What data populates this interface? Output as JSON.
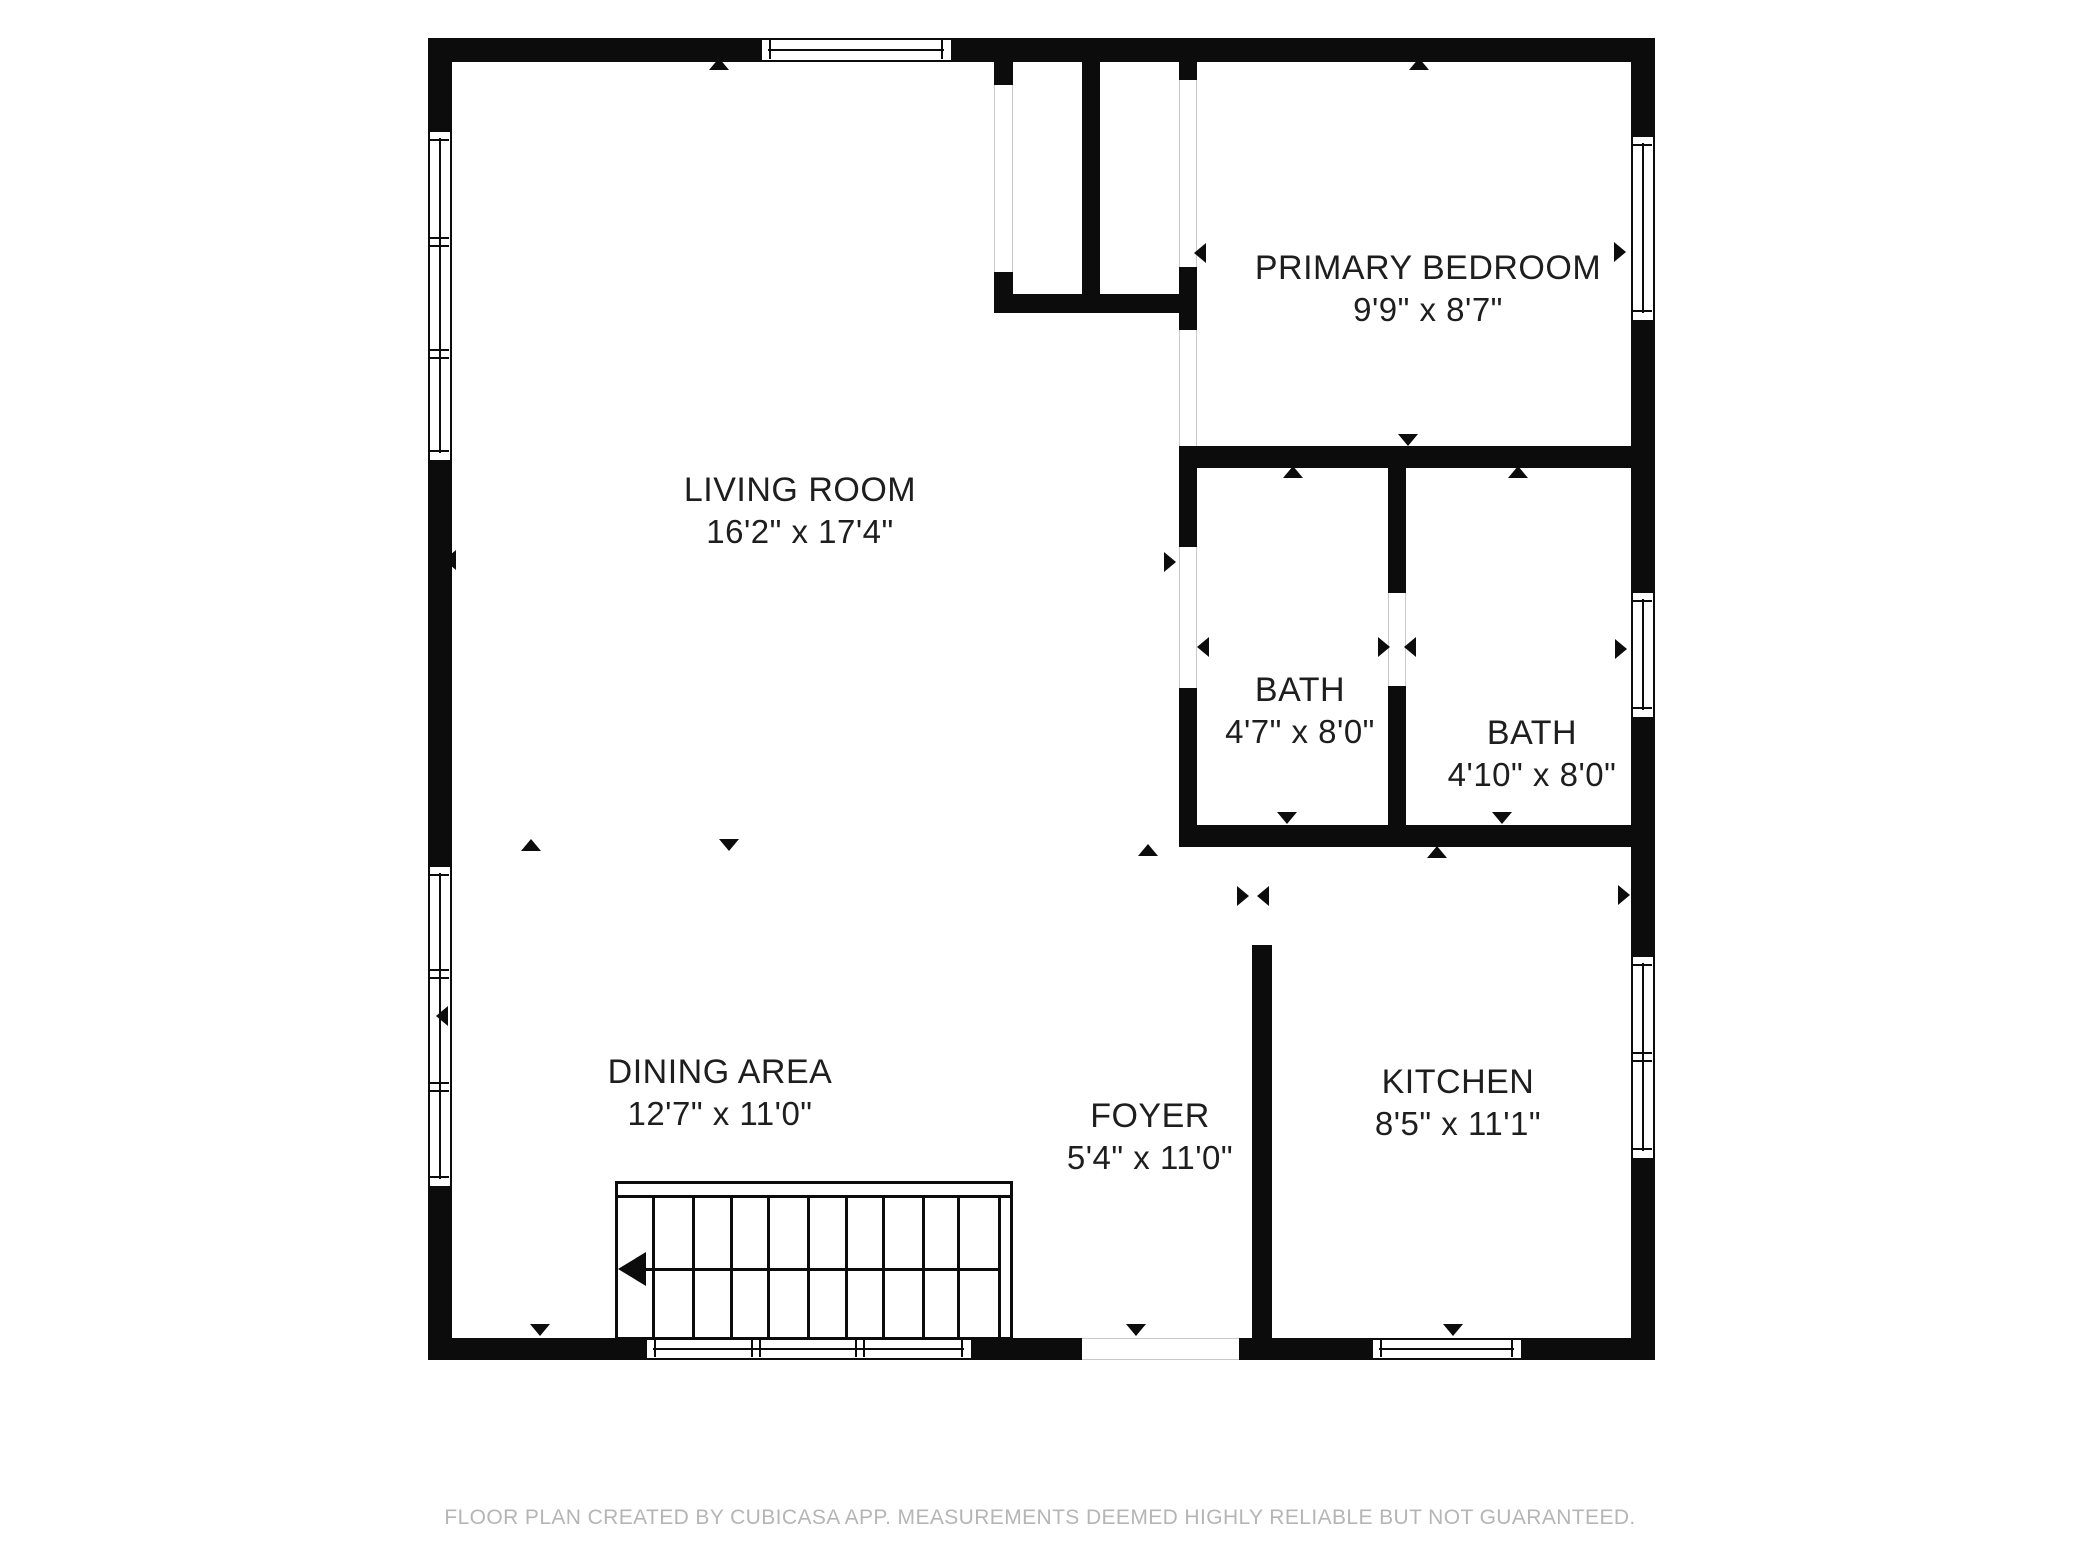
{
  "footer": {
    "text": "FLOOR PLAN CREATED BY CUBICASA APP. MEASUREMENTS DEEMED HIGHLY RELIABLE BUT NOT GUARANTEED."
  },
  "colors": {
    "wall": "#0c0c0c",
    "background": "#ffffff",
    "label_text": "#1e1e1e",
    "footer_text": "#b5b5b5",
    "gap_edge": "#c9c9c9"
  },
  "canvas": {
    "width": 2080,
    "height": 1560
  },
  "rooms": [
    {
      "id": "living-room",
      "name": "LIVING ROOM",
      "dims": "16'2\" x 17'4\"",
      "cx": 800,
      "cy": 490
    },
    {
      "id": "primary-bedroom",
      "name": "PRIMARY BEDROOM",
      "dims": "9'9\" x 8'7\"",
      "cx": 1428,
      "cy": 268
    },
    {
      "id": "bath-1",
      "name": "BATH",
      "dims": "4'7\" x 8'0\"",
      "cx": 1300,
      "cy": 690
    },
    {
      "id": "bath-2",
      "name": "BATH",
      "dims": "4'10\" x 8'0\"",
      "cx": 1532,
      "cy": 733
    },
    {
      "id": "dining-area",
      "name": "DINING AREA",
      "dims": "12'7\" x 11'0\"",
      "cx": 720,
      "cy": 1072
    },
    {
      "id": "foyer",
      "name": "FOYER",
      "dims": "5'4\" x 11'0\"",
      "cx": 1150,
      "cy": 1116
    },
    {
      "id": "kitchen",
      "name": "KITCHEN",
      "dims": "8'5\" x 11'1\"",
      "cx": 1458,
      "cy": 1082
    }
  ],
  "walls": [
    {
      "x": 428,
      "y": 38,
      "w": 332,
      "h": 24
    },
    {
      "x": 953,
      "y": 38,
      "w": 702,
      "h": 24
    },
    {
      "x": 428,
      "y": 38,
      "w": 24,
      "h": 92
    },
    {
      "x": 428,
      "y": 462,
      "w": 24,
      "h": 403
    },
    {
      "x": 428,
      "y": 1188,
      "w": 24,
      "h": 172
    },
    {
      "x": 1631,
      "y": 38,
      "w": 24,
      "h": 97
    },
    {
      "x": 1631,
      "y": 322,
      "w": 24,
      "h": 269
    },
    {
      "x": 1631,
      "y": 719,
      "w": 24,
      "h": 236
    },
    {
      "x": 1631,
      "y": 1160,
      "w": 24,
      "h": 200
    },
    {
      "x": 428,
      "y": 1338,
      "w": 217,
      "h": 22
    },
    {
      "x": 973,
      "y": 1338,
      "w": 109,
      "h": 22
    },
    {
      "x": 1239,
      "y": 1338,
      "w": 132,
      "h": 22
    },
    {
      "x": 1523,
      "y": 1338,
      "w": 132,
      "h": 22
    },
    {
      "x": 1082,
      "y": 62,
      "w": 18,
      "h": 251
    },
    {
      "x": 994,
      "y": 62,
      "w": 19,
      "h": 23
    },
    {
      "x": 994,
      "y": 272,
      "w": 19,
      "h": 22
    },
    {
      "x": 994,
      "y": 294,
      "w": 189,
      "h": 19
    },
    {
      "x": 1179,
      "y": 62,
      "w": 18,
      "h": 18
    },
    {
      "x": 1179,
      "y": 267,
      "w": 18,
      "h": 63
    },
    {
      "x": 1179,
      "y": 446,
      "w": 476,
      "h": 22
    },
    {
      "x": 1179,
      "y": 468,
      "w": 18,
      "h": 79
    },
    {
      "x": 1179,
      "y": 688,
      "w": 18,
      "h": 159
    },
    {
      "x": 1388,
      "y": 468,
      "w": 18,
      "h": 125
    },
    {
      "x": 1388,
      "y": 686,
      "w": 18,
      "h": 161
    },
    {
      "x": 1179,
      "y": 825,
      "w": 476,
      "h": 22
    },
    {
      "x": 1252,
      "y": 945,
      "w": 20,
      "h": 415
    }
  ],
  "windows": [
    {
      "orient": "h",
      "x": 760,
      "y": 38,
      "len": 193,
      "th": 24,
      "divs": []
    },
    {
      "orient": "v",
      "x": 428,
      "y": 130,
      "len": 332,
      "th": 24,
      "divs": [
        110,
        222
      ]
    },
    {
      "orient": "v",
      "x": 428,
      "y": 865,
      "len": 323,
      "th": 24,
      "divs": [
        107,
        220
      ]
    },
    {
      "orient": "v",
      "x": 1631,
      "y": 135,
      "len": 187,
      "th": 24,
      "divs": []
    },
    {
      "orient": "v",
      "x": 1631,
      "y": 591,
      "len": 128,
      "th": 24,
      "divs": []
    },
    {
      "orient": "v",
      "x": 1631,
      "y": 955,
      "len": 205,
      "th": 24,
      "divs": [
        100
      ]
    },
    {
      "orient": "h",
      "x": 645,
      "y": 1338,
      "len": 328,
      "th": 22,
      "divs": [
        109,
        213
      ]
    },
    {
      "orient": "h",
      "x": 1371,
      "y": 1338,
      "len": 152,
      "th": 22,
      "divs": []
    }
  ],
  "door_gaps": [
    {
      "orient": "v",
      "x": 994,
      "y": 85,
      "w": 19,
      "h": 187
    },
    {
      "orient": "v",
      "x": 1179,
      "y": 80,
      "w": 18,
      "h": 187
    },
    {
      "orient": "v",
      "x": 1179,
      "y": 330,
      "w": 18,
      "h": 116
    },
    {
      "orient": "v",
      "x": 1179,
      "y": 547,
      "w": 18,
      "h": 141
    },
    {
      "orient": "v",
      "x": 1388,
      "y": 593,
      "w": 18,
      "h": 93
    },
    {
      "orient": "h",
      "x": 1082,
      "y": 1338,
      "w": 157,
      "h": 22
    }
  ],
  "stairs": {
    "x": 615,
    "y": 1181,
    "w": 398,
    "h": 159,
    "inner_top": 11,
    "inner_right": 380,
    "treads": [
      34,
      74,
      112,
      149,
      189,
      227,
      264,
      304,
      339
    ],
    "dir_line_y": 84,
    "dir_line_x1": 14,
    "dir_line_x2": 380
  },
  "markers": [
    {
      "dir": "up",
      "x": 719,
      "y": 64
    },
    {
      "dir": "up",
      "x": 1419,
      "y": 64
    },
    {
      "dir": "left",
      "x": 1200,
      "y": 253
    },
    {
      "dir": "right",
      "x": 1620,
      "y": 252
    },
    {
      "dir": "left",
      "x": 450,
      "y": 560
    },
    {
      "dir": "left",
      "x": 442,
      "y": 1016
    },
    {
      "dir": "up",
      "x": 531,
      "y": 845
    },
    {
      "dir": "down",
      "x": 729,
      "y": 845
    },
    {
      "dir": "up",
      "x": 1148,
      "y": 850
    },
    {
      "dir": "down",
      "x": 1408,
      "y": 440
    },
    {
      "dir": "right",
      "x": 1170,
      "y": 562
    },
    {
      "dir": "left",
      "x": 1203,
      "y": 647
    },
    {
      "dir": "up",
      "x": 1293,
      "y": 472
    },
    {
      "dir": "up",
      "x": 1518,
      "y": 472
    },
    {
      "dir": "right",
      "x": 1384,
      "y": 647
    },
    {
      "dir": "left",
      "x": 1410,
      "y": 647
    },
    {
      "dir": "right",
      "x": 1621,
      "y": 649
    },
    {
      "dir": "right",
      "x": 1624,
      "y": 895
    },
    {
      "dir": "down",
      "x": 1287,
      "y": 818
    },
    {
      "dir": "down",
      "x": 1502,
      "y": 818
    },
    {
      "dir": "up",
      "x": 1437,
      "y": 852
    },
    {
      "dir": "right",
      "x": 1243,
      "y": 896
    },
    {
      "dir": "left",
      "x": 1263,
      "y": 896
    },
    {
      "dir": "down",
      "x": 540,
      "y": 1330
    },
    {
      "dir": "down",
      "x": 1136,
      "y": 1330
    },
    {
      "dir": "down",
      "x": 1453,
      "y": 1330
    }
  ]
}
